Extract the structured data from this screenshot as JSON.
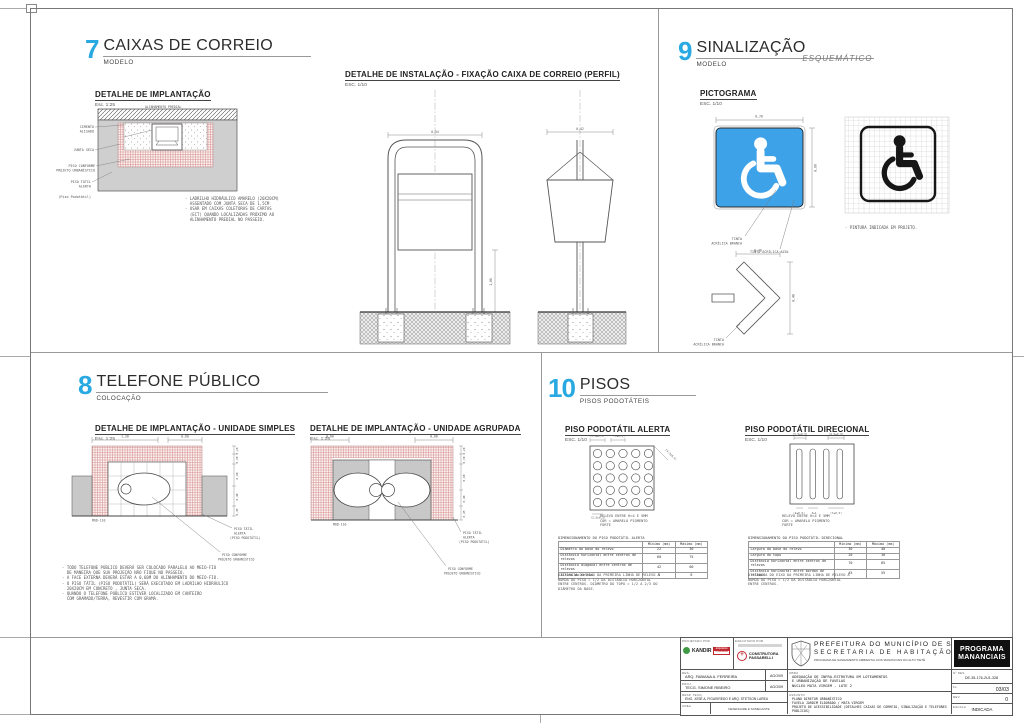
{
  "colors": {
    "accent_blue": "#29a9e2",
    "sign_blue": "#3ea2e8",
    "tactile_red": "#d89090",
    "logo_red": "#c22830",
    "logo_green": "#3f9a44"
  },
  "p7": {
    "number": "7",
    "title": "CAIXAS DE CORREIO",
    "subtitle": "MODELO",
    "impl": {
      "title": "DETALHE DE IMPLANTAÇÃO",
      "scale": "Esc. 1:25",
      "wall_label": "ALINHAMENTO PREDIAL",
      "labels": [
        "CIMENTO",
        "ALISADO",
        "JUNTA SECA",
        "PISO CONFORME",
        "PROJETO URBANÍSTICO",
        "PISO TÁTIL",
        "ALERTA",
        "(Piso Podotátil)"
      ],
      "notes": [
        "- LADRILHO HIDRÁULICO AMARELO (20X20CM)",
        "  ASSENTADO COM JUNTA SECA DE 1,5CM",
        "- USAR EM CAIXAS COLETORAS DE CARTAS",
        "  (ECT) QUANDO LOCALIZADAS PRÓXIMO AO",
        "  ALINHAMENTO PREDIAL NO PASSEIO."
      ]
    },
    "inst": {
      "title": "DETALHE DE INSTALAÇÃO - FIXAÇÃO CAIXA DE CORREIO (PERFIL)",
      "scale": "ESC. 1/10",
      "dim_front": "0,54",
      "dim_profile": "0,42",
      "dim_height": "1,06"
    }
  },
  "p9": {
    "number": "9",
    "title": "SINALIZAÇÃO",
    "subtitle": "MODELO",
    "tag": "ESQUEMÁTICO",
    "picto": {
      "title": "PICTOGRAMA",
      "scale": "ESC. 1/10",
      "dim_w": "0,70",
      "dim_h": "0,60",
      "label_white": [
        "TINTA",
        "ACRÍLICA BRANCA"
      ],
      "label_blue": "TINTA ACRÍLICA AZUL",
      "note": "- PINTURA INDICADA EM PROJETO."
    },
    "arrow": {
      "dim_w": "0,40",
      "dim_h": "0,40",
      "label": [
        "TINTA",
        "ACRÍLICA BRANCA"
      ]
    }
  },
  "p8": {
    "number": "8",
    "title": "TELEFONE PÚBLICO",
    "subtitle": "COLOCAÇÃO",
    "d1": {
      "title": "DETALHE DE IMPLANTAÇÃO - UNIDADE SIMPLES",
      "scale": "Esc. 1:25",
      "dims_top": [
        "1,20",
        "0,60"
      ],
      "dims_right": [
        "0,20",
        "0,30",
        "0,90",
        "0,40",
        "0,45"
      ],
      "mod": "MOD-110",
      "lbl_alerta": [
        "PISO TÁTIL",
        "ALERTA",
        "(PISO PODOTÁTIL)"
      ],
      "lbl_piso": [
        "PISO CONFORME",
        "PROJETO URBANÍSTICO"
      ]
    },
    "d2": {
      "title": "DETALHE DE IMPLANTAÇÃO - UNIDADE AGRUPADA",
      "scale": "Esc. 1:25",
      "dims_top": [
        "0,60",
        "0,60"
      ],
      "dims_right": [
        "0,20",
        "0,30",
        "0,90",
        "0,40",
        "0,45"
      ],
      "mod": "MOD-110",
      "lbl_alerta": [
        "PISO TÁTIL",
        "ALERTA",
        "(PISO PODOTÁTIL)"
      ],
      "lbl_piso": [
        "PISO CONFORME",
        "PROJETO URBANÍSTICO"
      ]
    },
    "notes": [
      "- TODO TELEFONE PÚBLICO DEVERÁ SER COLOCADO PARALELO AO MEIO-FIO",
      "  DE MANEIRA QUE SUA PROJEÇÃO NÃO FIQUE NO PASSEIO.",
      "- A FACE EXTERNA DEVERÁ ESTAR A 0,60M DO ALINHAMENTO DO MEIO-FIO.",
      "- O PISO TÁTIL (PISO PODOTÁTIL) SERÁ EXECUTADO EM LADRILHO HIDRÁULICO",
      "  20X20CM EM CONCRETO , JUNTA SECA.",
      "- QUANDO O TELEFONE PÚBLICO ESTIVER LOCALIZADO EM CANTEIRO",
      "  COM GRAMADO/TERRA, REVESTIR COM GRAMA."
    ]
  },
  "p10": {
    "number": "10",
    "title": "PISOS",
    "subtitle": "PISOS PODOTÁTEIS",
    "alerta": {
      "title": "PISO PODOTÁTIL ALERTA",
      "scale": "ESC. 1/10",
      "dims": [
        "(3,5±0,5)",
        "(7±0,5)",
        "(4,5±0,5)",
        "(2,5±0,5)"
      ],
      "note": [
        "RELEVO ENTRE H=4 E 5MM",
        "COR = AMARELO PIGMENTO",
        "FORTE"
      ],
      "table": {
        "title": "DIMENSIONAMENTO DO PISO PODOTÁTIL ALERTA",
        "cols": [
          "",
          "Mínimo (mm)",
          "Máximo (mm)"
        ],
        "rows": [
          [
            "Diâmetro da base do relevo",
            "22",
            "30"
          ],
          [
            "Distância horizontal entre centros de relevos",
            "60",
            "75"
          ],
          [
            "Distância diagonal entre centros de relevos",
            "42",
            "60"
          ],
          [
            "Altura do relevo",
            "4",
            "6"
          ]
        ]
      },
      "footnote": [
        "DISTÂNCIA DO EIXO DA PRIMEIRA LINHA DE RELEVO À",
        "BORDA DO PISO = 1/2 DA DISTÂNCIA HORIZONTAL",
        "ENTRE CENTROS. DIÂMETRO DO TOPO = 1/2 A 2/3 DO",
        "DIÂMETRO DA BASE."
      ]
    },
    "direcional": {
      "title": "PISO PODOTÁTIL DIRECIONAL",
      "scale": "ESC. 1/10",
      "dims": [
        "(3,5±0,5)",
        "(4,5±0,5)",
        "(2±0,5)",
        "3±1",
        "(7±0,5)"
      ],
      "note": [
        "RELEVO ENTRE H=4 E 5MM",
        "COR = AMARELO PIGMENTO",
        "FORTE"
      ],
      "table": {
        "title": "DIMENSIONAMENTO DO PISO PODOTÁTIL DIRECIONAL",
        "cols": [
          "",
          "Mínimo (mm)",
          "Máximo (mm)"
        ],
        "rows": [
          [
            "Largura da base do relevo",
            "30",
            "40"
          ],
          [
            "Largura do topo",
            "20",
            "30"
          ],
          [
            "Distância horizontal entre centros de relevos",
            "70",
            "85"
          ],
          [
            "Distância horizontal entre bordas de relevos",
            "45",
            "55"
          ]
        ]
      },
      "footnote": [
        "DISTÂNCIA DO EIXO DA PRIMEIRA LINHA DE RELEVO À",
        "BORDA DO PISO = 1/2 DA DISTÂNCIA HORIZONTAL",
        "ENTRE CENTROS."
      ]
    }
  },
  "titleblock": {
    "projetado_label": "PROJETADO POR",
    "executado_label": "EXECUTADO POR",
    "logo_kandir": "KANDIR",
    "logo_arq": [
      "arquitetos",
      "urbanistas"
    ],
    "logo_construtora": [
      "CONSTRUTORA",
      "PASSARELLI"
    ],
    "rows": [
      {
        "label": "DES.",
        "name": "ARQ. FABIANA A. FERREIRA",
        "date": "AGO/09"
      },
      {
        "label": "PROJ.",
        "name": "TECG. SIMONE RIBEIRO",
        "date": "AGO/09"
      }
    ],
    "resp_label": "RESP. TECN.",
    "resp": "ENG. JOSÉ A. FIGUEIREDO E ARQ. STETSON LAREU",
    "crea_label": "CREA",
    "crea": "DESENHARE E SOMECANTE",
    "prefeitura": [
      "PREFEITURA DO MUNICÍPIO DE SÃO PAULO",
      "SECRETARIA DE HABITAÇÃO",
      "PROGRAMA DE SANEAMENTO AMBIENTAL DOS MANANCIAIS DO ALTO TIETÊ"
    ],
    "obra_label": "OBRA",
    "obra": [
      "ADEQUAÇÃO DE INFRA-ESTRUTURA EM LOTEAMENTOS",
      "E URBANIZAÇÃO DE FAVELAS",
      "NÚCLEO MATA VIRGEM - LOTE 2"
    ],
    "assunto_label": "ASSUNTO",
    "assunto": [
      "PLANO DIRETOR URBANÍSTICO",
      "FAVELA JARDIM ELDORADO / MATA VIRGEM",
      "PROJETO DE ACESSIBILIDADE (DETALHES CAIXAS DE CORREIO, SINALIZAÇÃO E TELEFONES PÚBLICOS)"
    ],
    "programa": [
      "PROGRAMA",
      "MANANCIAIS"
    ],
    "ndes_label": "Nº DES.",
    "ndes": "DE-35-176-2U1-328",
    "fl_label": "FL.",
    "fl": "03/03",
    "rev_label": "REV.",
    "rev": "0",
    "escala_label": "ESCALA",
    "escala": "INDICADA"
  }
}
